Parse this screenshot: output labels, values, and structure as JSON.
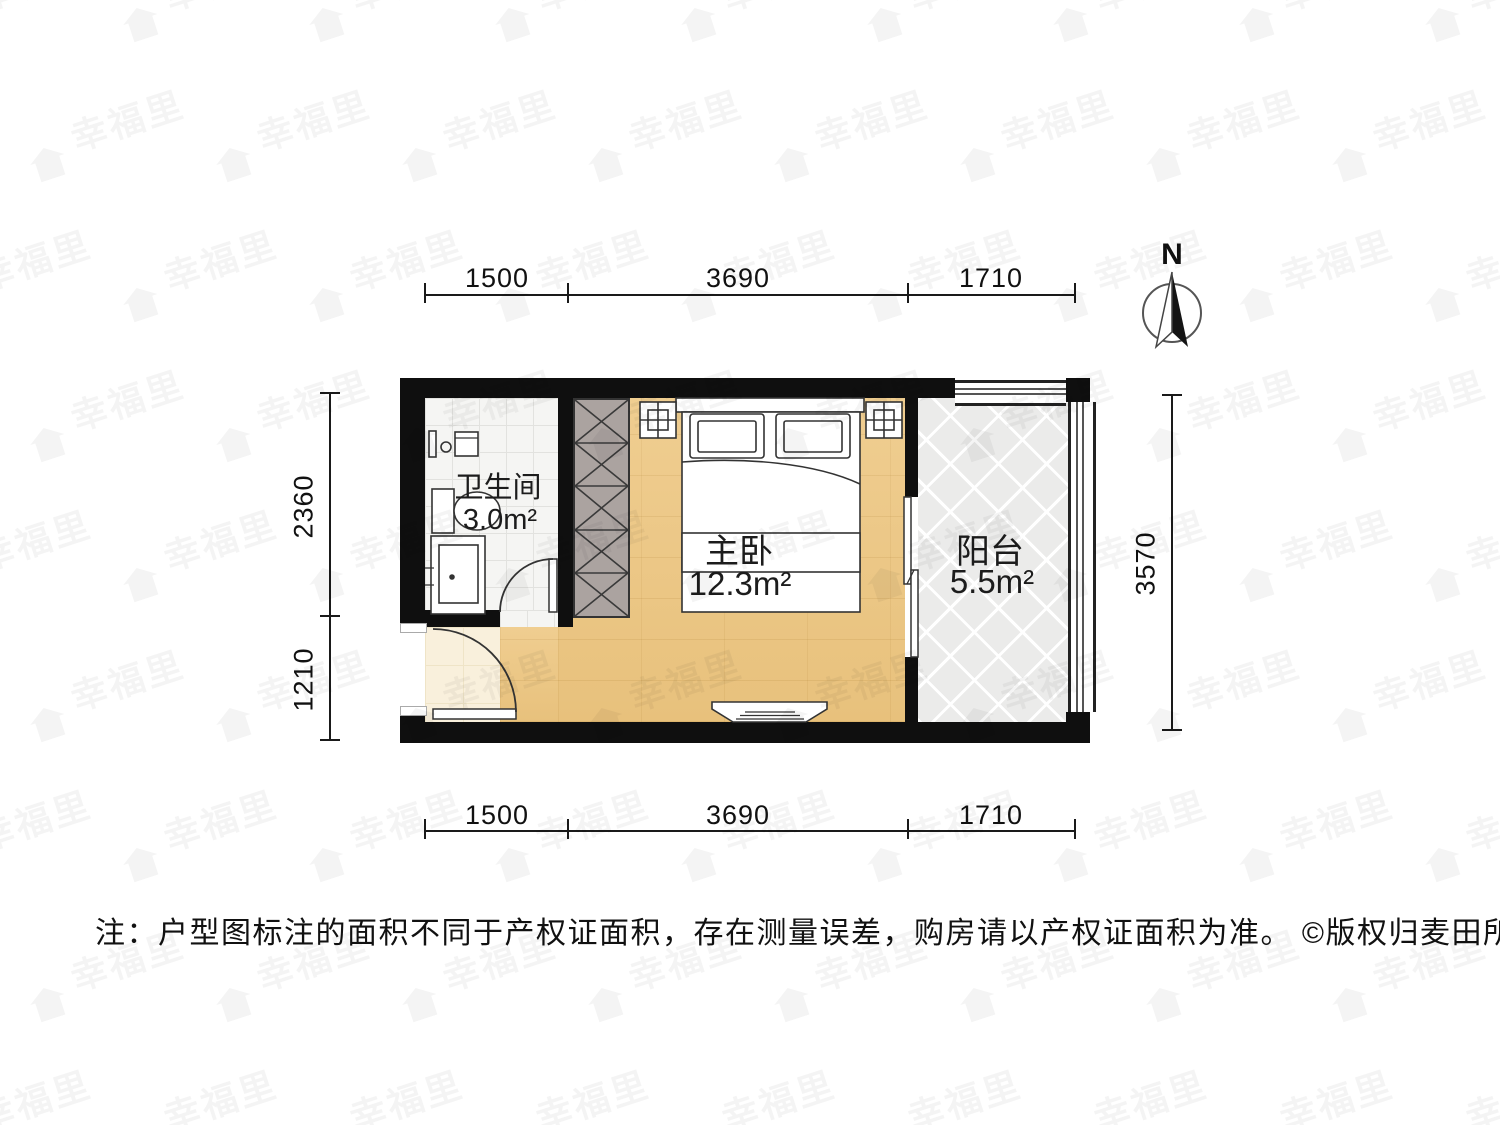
{
  "watermark": {
    "text": "幸福里"
  },
  "compass": {
    "label": "N"
  },
  "dimensions": {
    "top": [
      "1500",
      "3690",
      "1710"
    ],
    "bottom": [
      "1500",
      "3690",
      "1710"
    ],
    "left": [
      "2360",
      "1210"
    ],
    "right": [
      "3570"
    ]
  },
  "rooms": [
    {
      "name": "卫生间",
      "area": "3.0m²"
    },
    {
      "name": "主卧",
      "area": "12.3m²"
    },
    {
      "name": "阳台",
      "area": "5.5m²"
    }
  ],
  "note": "注：户型图标注的面积不同于产权证面积，存在测量误差，购房请以产权证面积为准。 ©版权归麦田所有",
  "colors": {
    "wall": "#0f0f0f",
    "wood_floor": "#eec884",
    "wardrobe": "#aba3a0",
    "bath_tile": "#f5f5f3",
    "balcony_tile": "#ebebea",
    "entry_tile": "#f9f0dc"
  }
}
